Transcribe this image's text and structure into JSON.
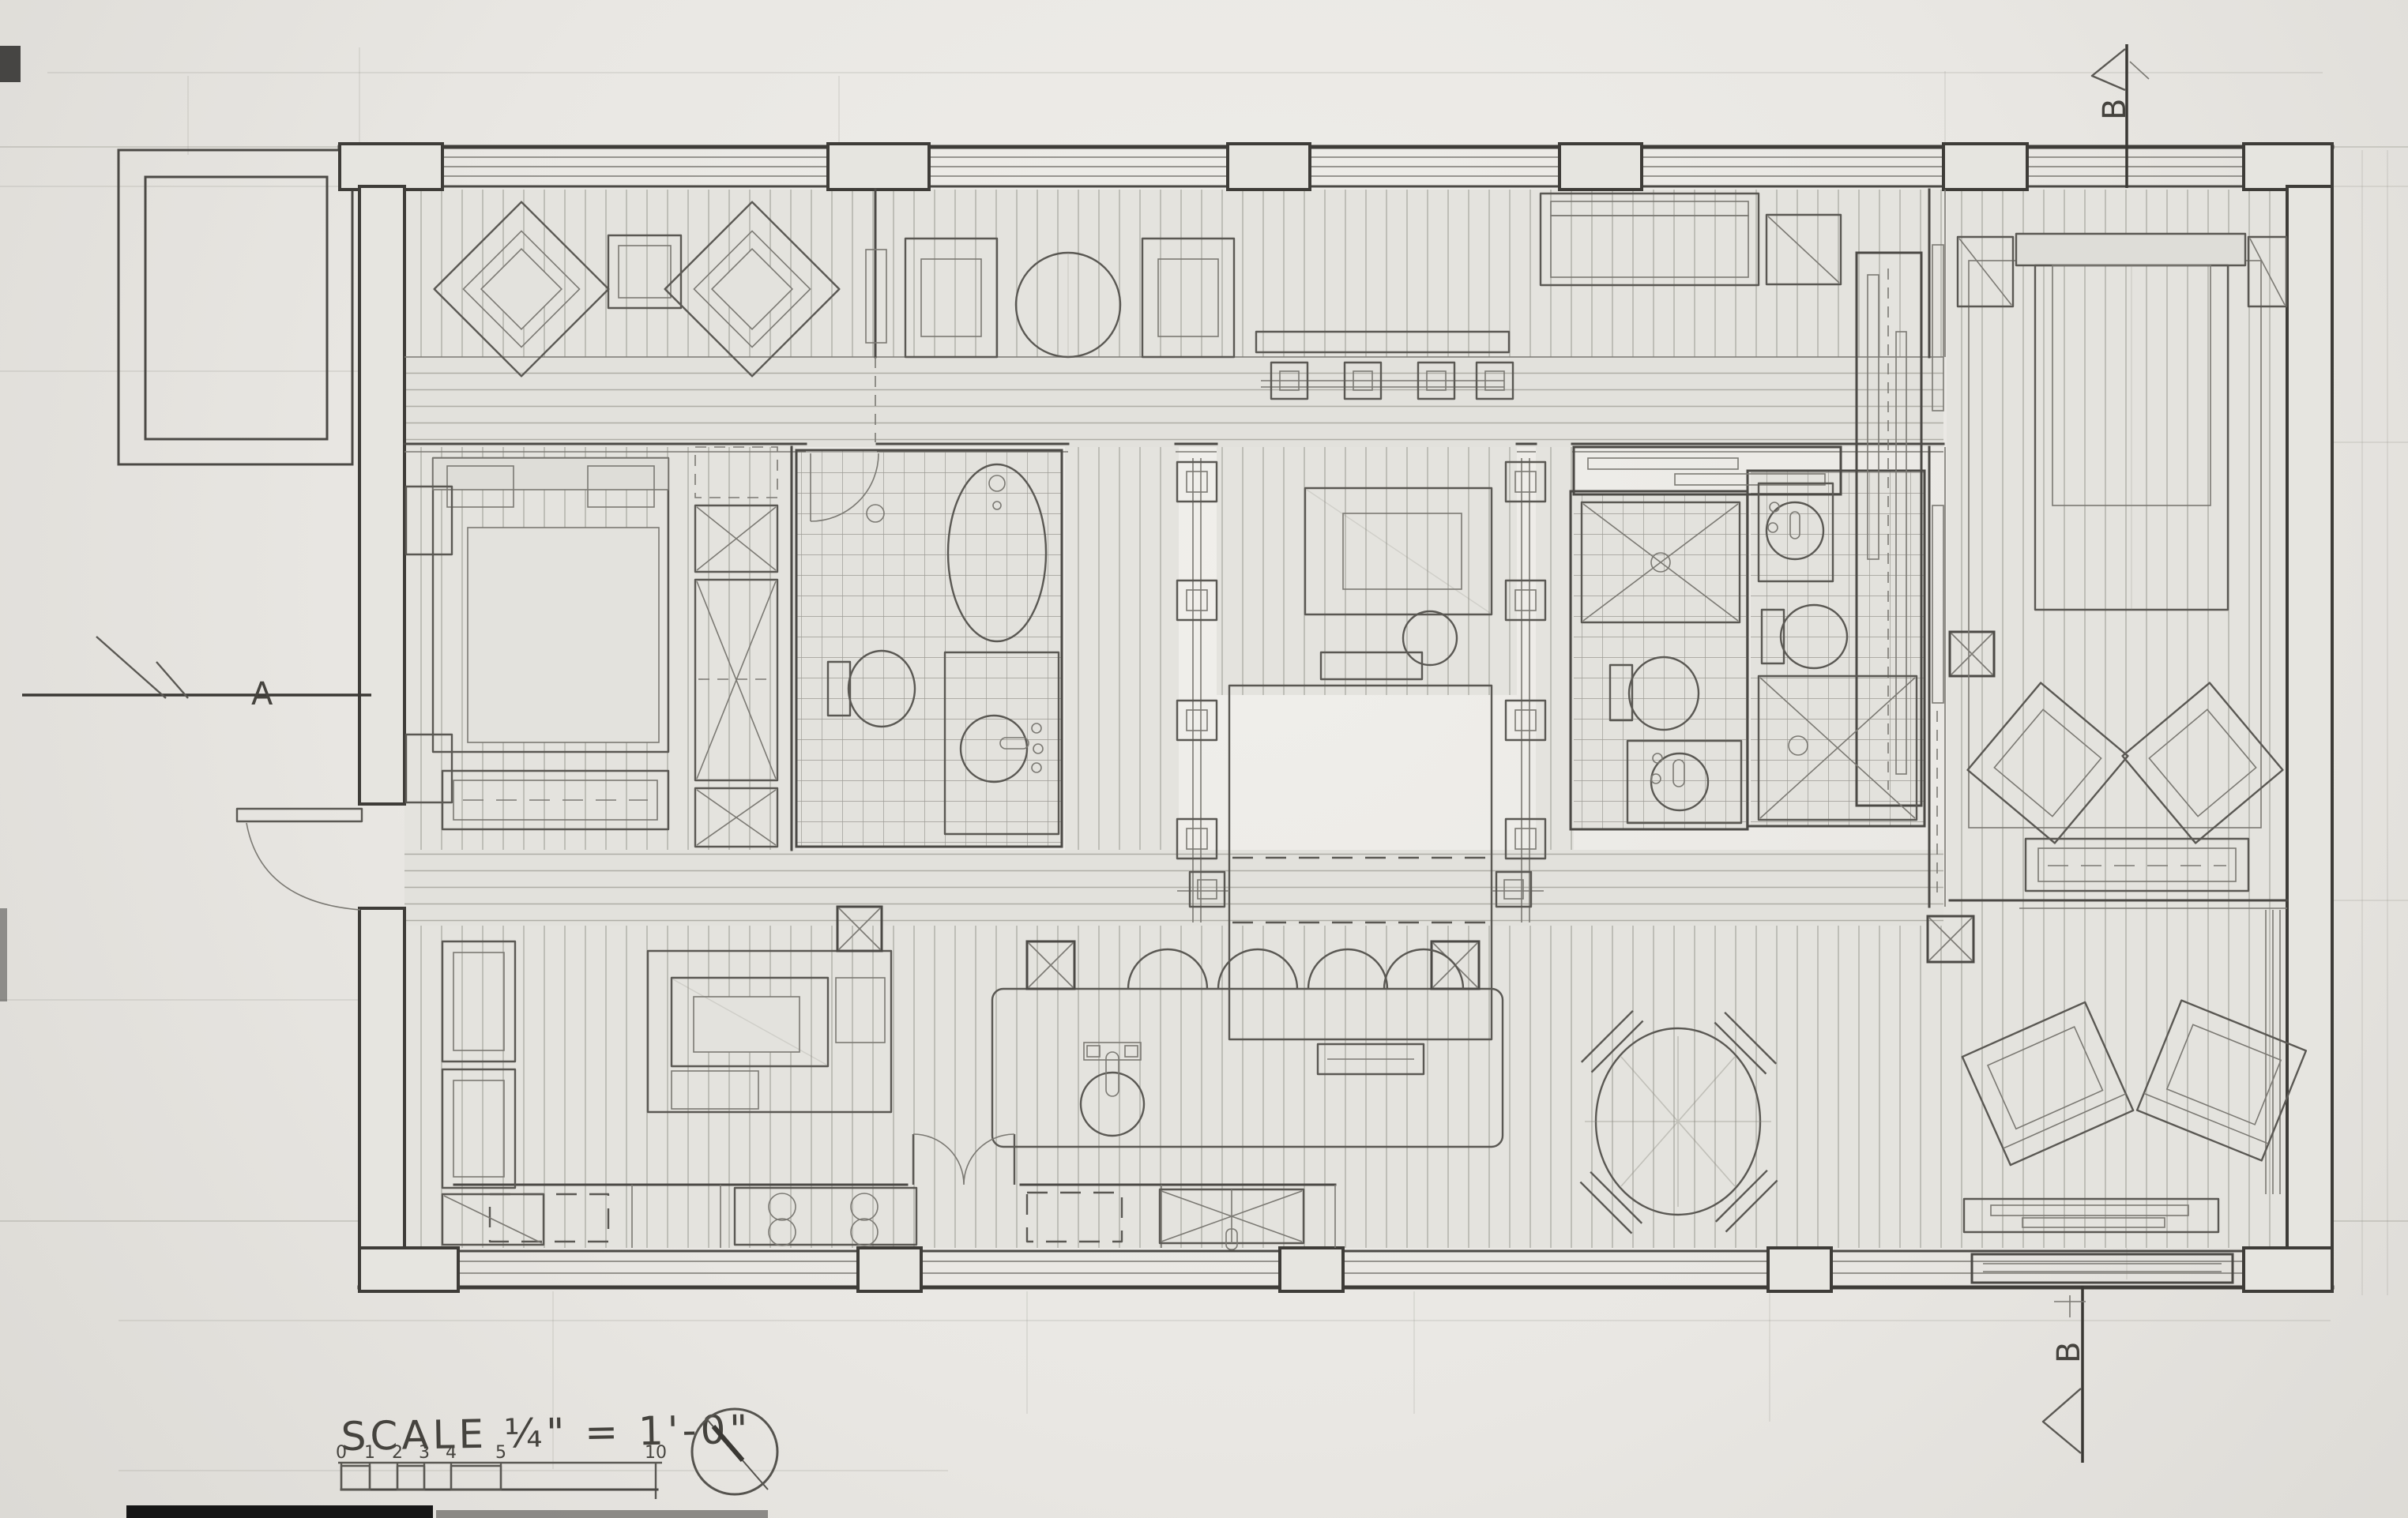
{
  "drawing": {
    "type": "hand-drafted floor plan, pencil on paper",
    "scale_label": "SCALE ¼\" = 1'-0\"",
    "scale_bar_numbers": [
      "0",
      "1",
      "2",
      "3",
      "4",
      "5",
      "10"
    ],
    "section_marker_a": "A",
    "section_marker_b_top": "B",
    "section_marker_b_bottom": "B",
    "icons": {
      "north_arrow": "north-arrow-compass-circle"
    },
    "colors": {
      "paper": "#ECEAE6",
      "pencil_dark": "#3E3C38",
      "pencil_mid": "#5A5853",
      "pencil_light": "#ADACA5"
    }
  }
}
